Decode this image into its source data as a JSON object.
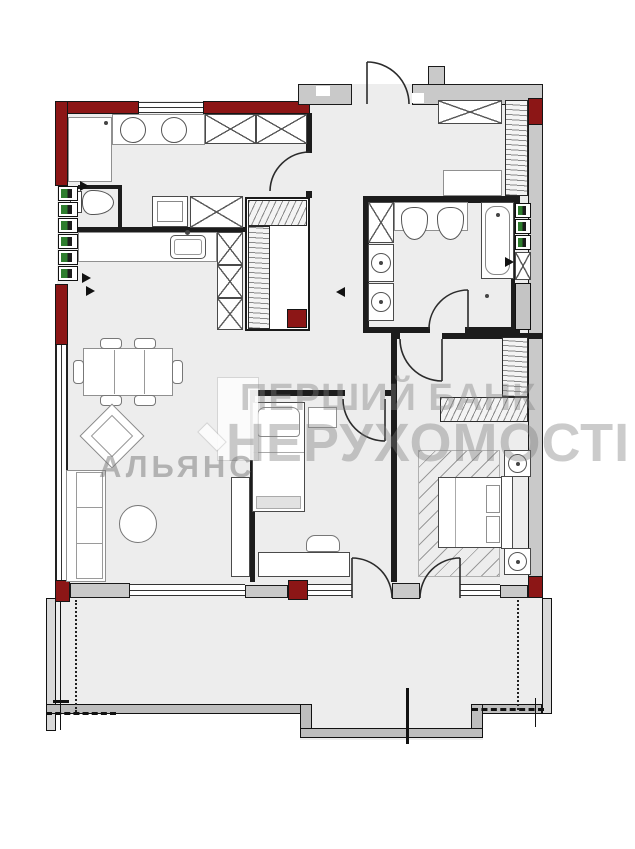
{
  "watermark": {
    "line1": "ПЕРШИЙ БАНК",
    "line2": "НЕРУХОМОСТІ",
    "brand": "АЛЬЯНС",
    "logo_icon": "numeral-1-logo"
  },
  "palette": {
    "wall_fill": "#c9c9c9",
    "accent_wall_red": "#8c1616",
    "floor_fill": "#ededed",
    "outline_black": "#1c1c1c",
    "furniture_outline": "#909090",
    "riser_green": "#2e7d2e",
    "watermark_gray": "rgba(125,125,125,0.40)"
  }
}
